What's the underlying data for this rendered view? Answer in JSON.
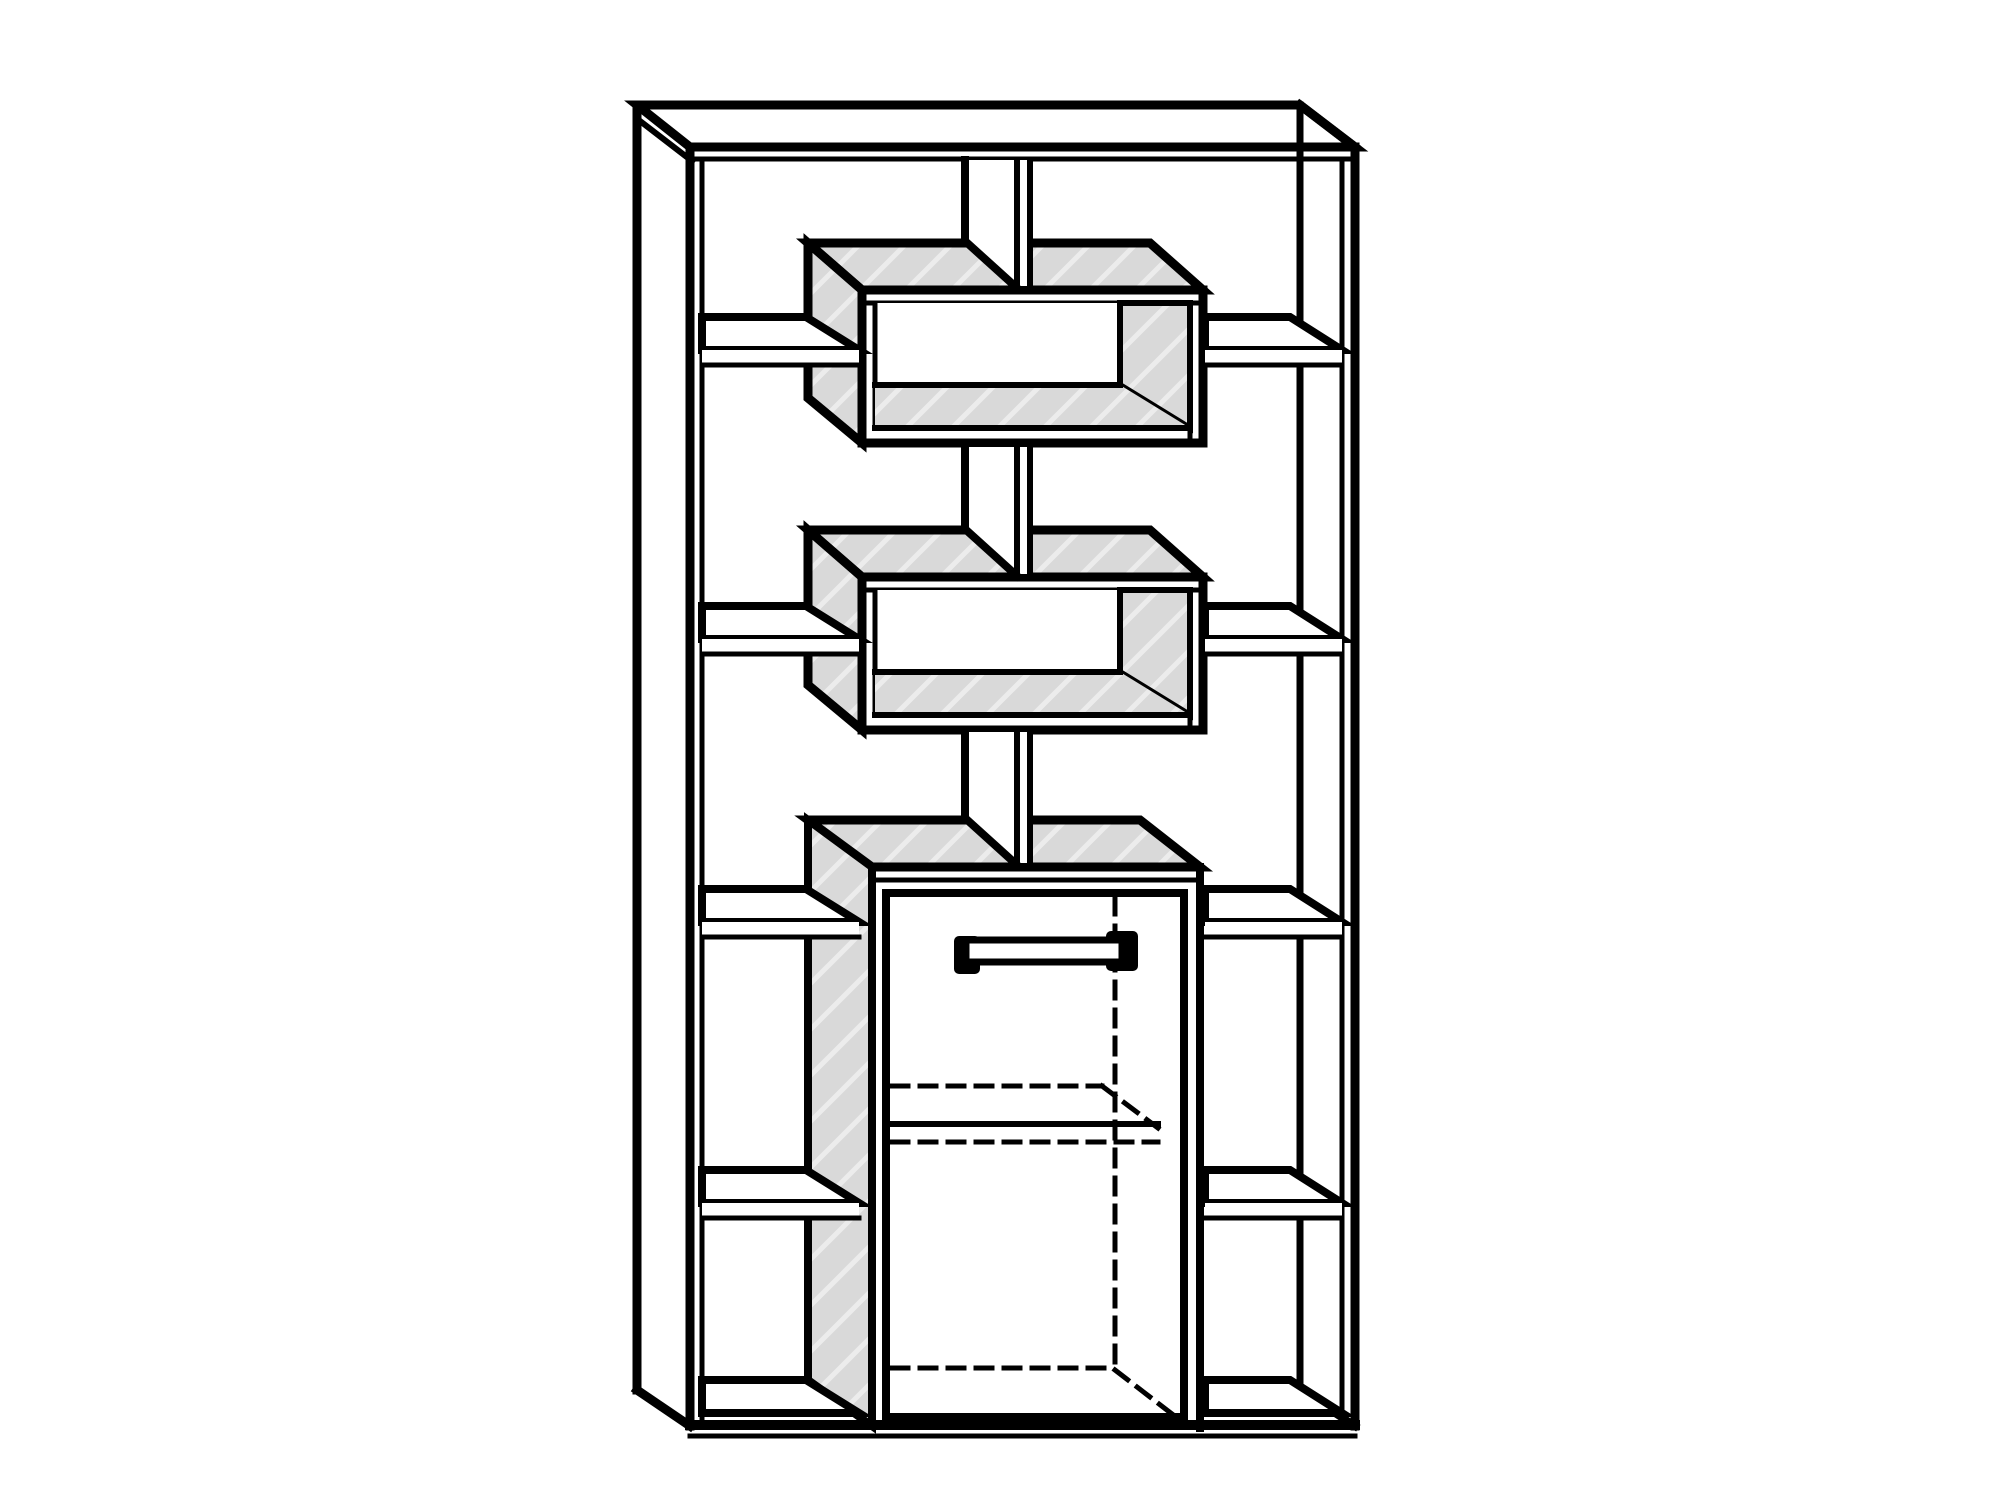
{
  "figure": {
    "type": "technical-line-drawing",
    "subject": "Tall open shelving room-divider unit: outer frame with top panel, central vertical divider panel carrying two floating box compartments with hatched gray surfaces, four staggered open shelves on the left and right columns, and a lower cabinet with a door, bar handle and dashed hidden interior edges (internal shelf and back corner)",
    "colors": {
      "background": "#ffffff",
      "line": "#000000",
      "face": "#d9d9d9",
      "hatch": "#ececec"
    },
    "line_style": {
      "main_px": 9,
      "thin_px": 5,
      "hidden_dash": "16 12"
    },
    "components": [
      "top-panel",
      "left-side-panel",
      "right-side-panel",
      "center-divider-panel",
      "upper-box-compartment",
      "lower-box-compartment",
      "left-shelf-1",
      "left-shelf-2",
      "left-shelf-3",
      "left-shelf-4",
      "right-shelf-1",
      "right-shelf-2",
      "right-shelf-3",
      "right-shelf-4",
      "cabinet",
      "cabinet-door",
      "door-handle",
      "bottom-shelf-left",
      "bottom-shelf-right",
      "base-edge",
      "hidden-interior-edges"
    ]
  }
}
